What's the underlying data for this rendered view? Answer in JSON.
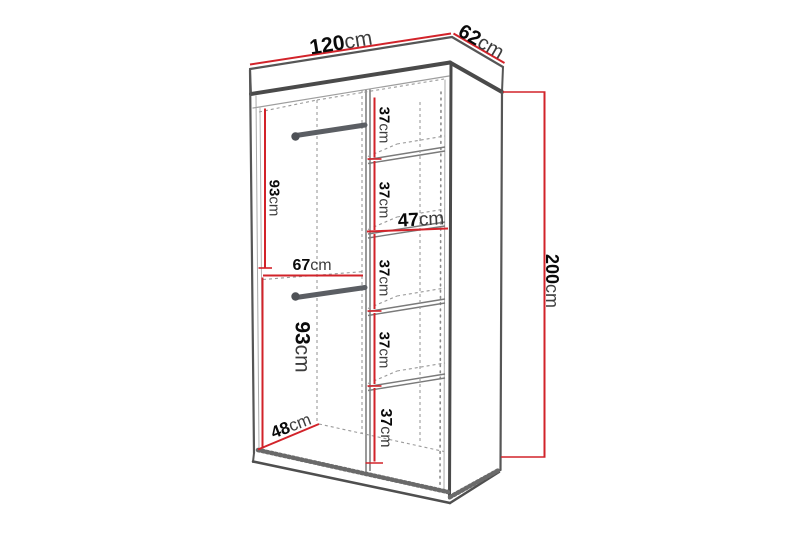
{
  "diagram": {
    "subject": "wardrobe-dimension-diagram",
    "unit": "cm",
    "colors": {
      "dimension_line": "#d2232a",
      "outline_dark": "#4a4a4a",
      "outline_mid": "#565656",
      "dashed_line": "#9a9a9a",
      "rail": "#5b5e63",
      "text_value": "#0a0a0a",
      "text_unit": "#3d3d3d",
      "background": "#ffffff"
    },
    "dims": {
      "width": {
        "value": "120",
        "unit": "cm"
      },
      "depth": {
        "value": "62",
        "unit": "cm"
      },
      "height": {
        "value": "200",
        "unit": "cm"
      },
      "hanging_top": {
        "value": "93",
        "unit": "cm"
      },
      "hanging_bottom": {
        "value": "93",
        "unit": "cm"
      },
      "left_section_width": {
        "value": "67",
        "unit": "cm"
      },
      "usable_depth": {
        "value": "48",
        "unit": "cm"
      },
      "shelf_width": {
        "value": "47",
        "unit": "cm"
      }
    },
    "shelves": [
      {
        "value": "37",
        "unit": "cm"
      },
      {
        "value": "37",
        "unit": "cm"
      },
      {
        "value": "37",
        "unit": "cm"
      },
      {
        "value": "37",
        "unit": "cm"
      },
      {
        "value": "37",
        "unit": "cm"
      }
    ]
  }
}
